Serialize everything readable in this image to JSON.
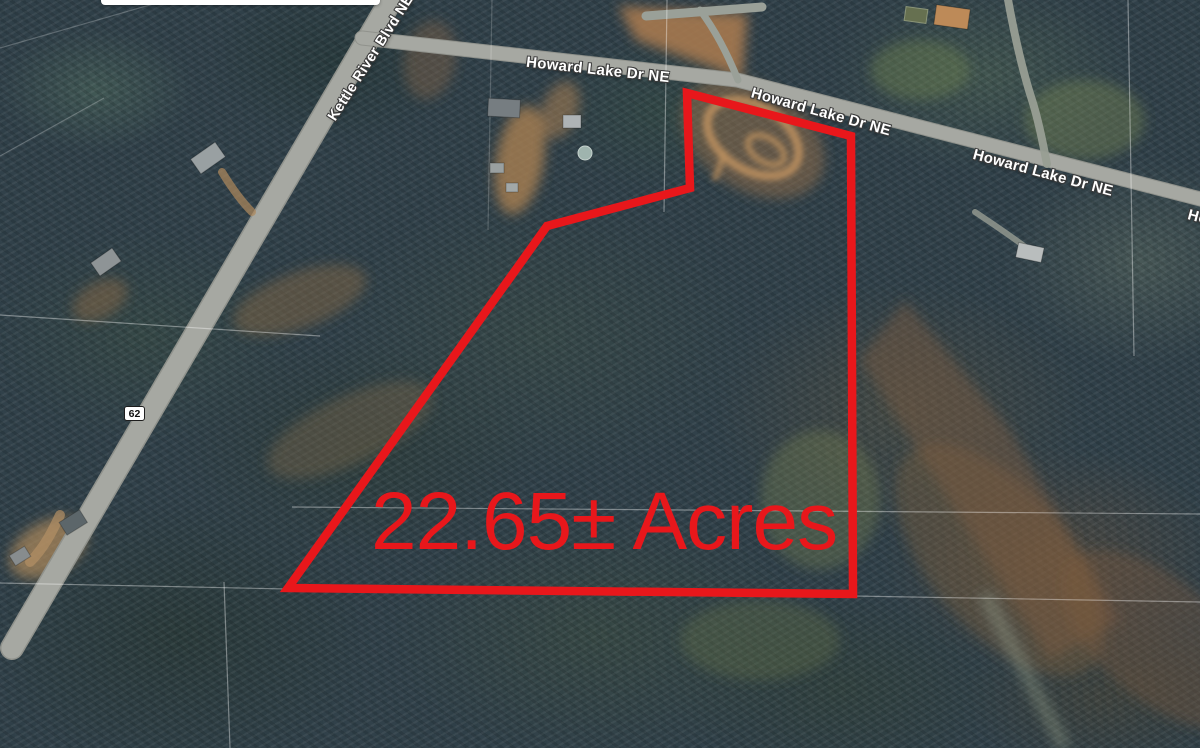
{
  "roads": {
    "howard_label_1": "Howard Lake Dr NE",
    "howard_label_2": "Howard Lake Dr NE",
    "howard_label_3": "Howard Lake Dr NE",
    "howard_label_4": "Howard Lake Dr NE",
    "kettle_label": "Kettle River Blvd NE",
    "route_shield": "62"
  },
  "parcel": {
    "acreage_label": "22.65± Acres",
    "outline_color": "#e8171b",
    "outline_points": [
      [
        687,
        93
      ],
      [
        851,
        136
      ],
      [
        853,
        594
      ],
      [
        288,
        588
      ],
      [
        547,
        226
      ],
      [
        690,
        188
      ]
    ]
  },
  "palette": {
    "annotation_red": "#e8171b",
    "road_gray": "#a6a8a2",
    "label_white": "#ffffff"
  }
}
